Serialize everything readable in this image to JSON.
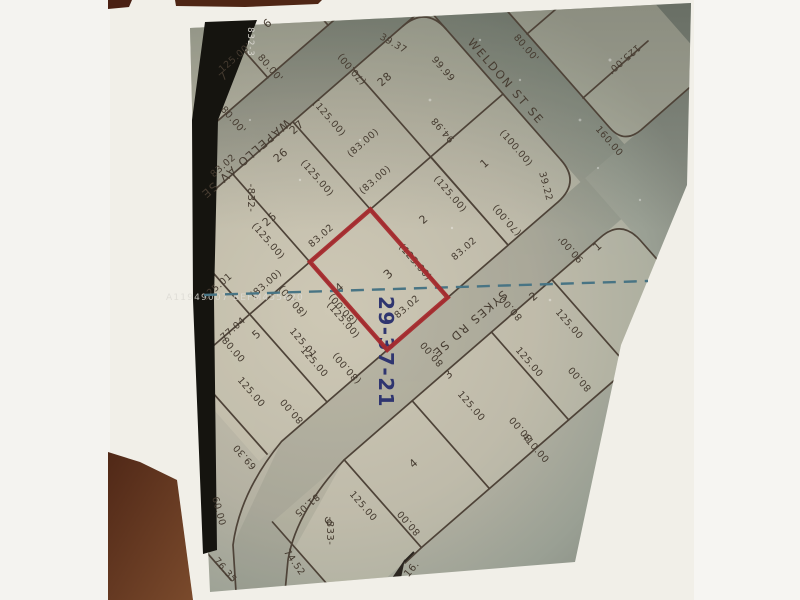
{
  "plat": {
    "colors": {
      "highlight": "#a62b2e",
      "stamp": "#2f3570",
      "dash": "#487484",
      "ink": "#4e4338"
    },
    "labels": [
      {
        "t": "6",
        "x": 270,
        "y": 26,
        "r": -41,
        "s": 11,
        "n": "lot-6-number"
      },
      {
        "t": "125.00'",
        "x": 237,
        "y": 60,
        "r": -41,
        "s": 9.5,
        "n": "dimension-label"
      },
      {
        "t": "7",
        "x": 226,
        "y": 79,
        "r": -41,
        "s": 11,
        "n": "lot-7-number"
      },
      {
        "t": "80.00'",
        "x": 268,
        "y": 70,
        "r": 49,
        "s": 9.5,
        "n": "dimension-label"
      },
      {
        "t": "80.00'",
        "x": 231,
        "y": 122,
        "r": 49,
        "s": 9.5,
        "n": "dimension-label"
      },
      {
        "t": "WAPELLO AV SE",
        "x": 243,
        "y": 156,
        "r": 139,
        "s": 11.5,
        "c": "street",
        "n": "street-name-wapello"
      },
      {
        "t": "(70.00)",
        "x": 354,
        "y": 67,
        "r": 229,
        "s": 9.5,
        "n": "dimension-label"
      },
      {
        "t": "39.37",
        "x": 392,
        "y": 46,
        "r": 30,
        "s": 9.5,
        "n": "dimension-label"
      },
      {
        "t": "28",
        "x": 387,
        "y": 82,
        "r": -41,
        "s": 11,
        "n": "lot-28-number"
      },
      {
        "t": "99.99",
        "x": 441,
        "y": 71,
        "r": 49,
        "s": 9.5,
        "n": "dimension-label"
      },
      {
        "t": "94.98",
        "x": 445,
        "y": 128,
        "r": 229,
        "s": 9.5,
        "n": "dimension-label"
      },
      {
        "t": "WELDON ST SE",
        "x": 503,
        "y": 84,
        "r": 49,
        "s": 11.5,
        "c": "street",
        "n": "street-name-weldon"
      },
      {
        "t": "80.00'",
        "x": 524,
        "y": 50,
        "r": 49,
        "s": 9.5,
        "n": "dimension-label"
      },
      {
        "t": "125.00'",
        "x": 622,
        "y": 57,
        "r": 139,
        "s": 9.5,
        "n": "dimension-label"
      },
      {
        "t": "160.00",
        "x": 607,
        "y": 143,
        "r": 49,
        "s": 9.5,
        "n": "dimension-label"
      },
      {
        "t": "27",
        "x": 299,
        "y": 130,
        "r": -41,
        "s": 11,
        "n": "lot-27-number"
      },
      {
        "t": "(125.00)",
        "x": 327,
        "y": 120,
        "r": 49,
        "s": 9.5,
        "n": "dimension-label"
      },
      {
        "t": "(83.00)",
        "x": 365,
        "y": 145,
        "r": -41,
        "s": 9.5,
        "n": "dimension-label"
      },
      {
        "t": "26",
        "x": 283,
        "y": 158,
        "r": -41,
        "s": 11,
        "n": "lot-26-number"
      },
      {
        "t": "83.02",
        "x": 225,
        "y": 168,
        "r": -41,
        "s": 9.5,
        "n": "dimension-label"
      },
      {
        "t": "(125.00)",
        "x": 315,
        "y": 180,
        "r": 49,
        "s": 9.5,
        "n": "dimension-label"
      },
      {
        "t": "(83.00)",
        "x": 377,
        "y": 182,
        "r": -41,
        "s": 9.5,
        "n": "dimension-label"
      },
      {
        "t": "-832-",
        "x": 248,
        "y": 198,
        "r": 90,
        "s": 10,
        "n": "block-832-number"
      },
      {
        "t": "25",
        "x": 272,
        "y": 222,
        "r": -41,
        "s": 11,
        "n": "lot-25-number"
      },
      {
        "t": "(125.00)",
        "x": 266,
        "y": 243,
        "r": 49,
        "s": 9.5,
        "n": "dimension-label"
      },
      {
        "t": "83.02",
        "x": 323,
        "y": 238,
        "r": -41,
        "s": 9.5,
        "n": "dimension-label"
      },
      {
        "t": "2",
        "x": 426,
        "y": 222,
        "r": -41,
        "s": 11,
        "n": "lot-2-number"
      },
      {
        "t": "(125.00)",
        "x": 448,
        "y": 196,
        "r": 49,
        "s": 9.5,
        "n": "dimension-label"
      },
      {
        "t": "1",
        "x": 487,
        "y": 166,
        "r": -41,
        "s": 11,
        "n": "lot-1-number"
      },
      {
        "t": "(100.00)",
        "x": 514,
        "y": 150,
        "r": 49,
        "s": 9.5,
        "n": "dimension-label"
      },
      {
        "t": "39.22",
        "x": 543,
        "y": 187,
        "r": 75,
        "s": 9.5,
        "n": "dimension-label"
      },
      {
        "t": "(70.00)",
        "x": 509,
        "y": 218,
        "r": 229,
        "s": 9.5,
        "n": "dimension-label"
      },
      {
        "t": "83.02",
        "x": 466,
        "y": 251,
        "r": -41,
        "s": 9.5,
        "n": "dimension-label"
      },
      {
        "t": "3",
        "x": 391,
        "y": 277,
        "r": -41,
        "s": 12,
        "n": "highlighted-lot-3-number"
      },
      {
        "t": "(125.00)",
        "x": 413,
        "y": 264,
        "r": 49,
        "s": 9.5,
        "n": "dimension-label"
      },
      {
        "t": "83.02",
        "x": 409,
        "y": 309,
        "r": -41,
        "s": 9.5,
        "n": "dimension-label"
      },
      {
        "t": "4",
        "x": 342,
        "y": 290,
        "r": -41,
        "s": 11,
        "n": "lot-4-number"
      },
      {
        "t": "(80.00)",
        "x": 345,
        "y": 307,
        "r": 229,
        "s": 9.5,
        "n": "dimension-label"
      },
      {
        "t": "(125.00)",
        "x": 341,
        "y": 322,
        "r": 49,
        "s": 9.5,
        "n": "dimension-label"
      },
      {
        "t": "125.01",
        "x": 219,
        "y": 289,
        "r": -41,
        "s": 9.5,
        "n": "dimension-label"
      },
      {
        "t": "(83.00)",
        "x": 268,
        "y": 286,
        "r": -41,
        "s": 9.5,
        "n": "dimension-label"
      },
      {
        "t": "(80.00)",
        "x": 295,
        "y": 299,
        "r": 229,
        "s": 9.5,
        "n": "dimension-label"
      },
      {
        "t": "77.04",
        "x": 235,
        "y": 331,
        "r": -41,
        "s": 9.5,
        "n": "dimension-label"
      },
      {
        "t": "5",
        "x": 259,
        "y": 337,
        "r": -41,
        "s": 11,
        "n": "lot-5-number"
      },
      {
        "t": "80.00",
        "x": 231,
        "y": 352,
        "r": 49,
        "s": 9.5,
        "n": "dimension-label"
      },
      {
        "t": "125.01",
        "x": 301,
        "y": 345,
        "r": 49,
        "s": 9.5,
        "n": "dimension-label"
      },
      {
        "t": "125.00",
        "x": 312,
        "y": 364,
        "r": 49,
        "s": 9.5,
        "n": "dimension-label"
      },
      {
        "t": "125.00",
        "x": 249,
        "y": 394,
        "r": 49,
        "s": 9.5,
        "n": "dimension-label"
      },
      {
        "t": "80.00",
        "x": 294,
        "y": 409,
        "r": 229,
        "s": 9.5,
        "n": "dimension-label"
      },
      {
        "t": "69.30",
        "x": 247,
        "y": 455,
        "r": 229,
        "s": 9.5,
        "n": "dimension-label"
      },
      {
        "t": "60.00",
        "x": 216,
        "y": 512,
        "r": 75,
        "s": 9.5,
        "n": "dimension-label"
      },
      {
        "t": "76.35",
        "x": 223,
        "y": 572,
        "r": 49,
        "s": 9.5,
        "n": "dimension-label"
      },
      {
        "t": "(80.00)",
        "x": 349,
        "y": 366,
        "r": 229,
        "s": 9.5,
        "n": "dimension-label"
      },
      {
        "t": "SYKES RD SE",
        "x": 467,
        "y": 321,
        "r": 139,
        "s": 11.5,
        "c": "street",
        "n": "street-name-sykes"
      },
      {
        "t": "2",
        "x": 536,
        "y": 299,
        "r": -41,
        "s": 11,
        "n": "lot-2-number-block-833"
      },
      {
        "t": "80.00",
        "x": 513,
        "y": 306,
        "r": 229,
        "s": 9.5,
        "n": "dimension-label"
      },
      {
        "t": "125.00",
        "x": 567,
        "y": 326,
        "r": 49,
        "s": 9.5,
        "n": "dimension-label"
      },
      {
        "t": "80.00",
        "x": 582,
        "y": 377,
        "r": 229,
        "s": 9.5,
        "n": "dimension-label"
      },
      {
        "t": "125.00",
        "x": 527,
        "y": 364,
        "r": 49,
        "s": 9.5,
        "n": "dimension-label"
      },
      {
        "t": "3",
        "x": 451,
        "y": 377,
        "r": -41,
        "s": 11,
        "n": "lot-3-number-block-833"
      },
      {
        "t": "80.00",
        "x": 434,
        "y": 352,
        "r": 229,
        "s": 9.5,
        "n": "dimension-label"
      },
      {
        "t": "125.00",
        "x": 469,
        "y": 408,
        "r": 49,
        "s": 9.5,
        "n": "dimension-label"
      },
      {
        "t": "4",
        "x": 416,
        "y": 466,
        "r": -41,
        "s": 11,
        "n": "lot-4-number-block-833"
      },
      {
        "t": "80.00",
        "x": 523,
        "y": 427,
        "r": 229,
        "s": 9.5,
        "n": "dimension-label"
      },
      {
        "t": "410.00",
        "x": 533,
        "y": 450,
        "r": 49,
        "s": 9.5,
        "n": "dimension-label"
      },
      {
        "t": "80.00",
        "x": 411,
        "y": 521,
        "r": 229,
        "s": 9.5,
        "n": "dimension-label"
      },
      {
        "t": "6",
        "x": 331,
        "y": 524,
        "r": -41,
        "s": 11,
        "n": "lot-6-number-block-833"
      },
      {
        "t": "81.05",
        "x": 305,
        "y": 503,
        "r": 139,
        "s": 9.5,
        "n": "dimension-label"
      },
      {
        "t": "-833-",
        "x": 327,
        "y": 531,
        "r": 90,
        "s": 10,
        "n": "block-833-number"
      },
      {
        "t": "125.00",
        "x": 361,
        "y": 508,
        "r": 49,
        "s": 9.5,
        "n": "dimension-label"
      },
      {
        "t": "74.52",
        "x": 292,
        "y": 564,
        "r": 55,
        "s": 9.5,
        "n": "dimension-label"
      },
      {
        "t": "16.",
        "x": 414,
        "y": 571,
        "r": -50,
        "s": 10,
        "n": "match-line-label"
      },
      {
        "t": "1",
        "x": 600,
        "y": 249,
        "r": -41,
        "s": 11,
        "n": "lot-1-number-block-833"
      },
      {
        "t": "90.00'",
        "x": 573,
        "y": 247,
        "r": 229,
        "s": 9.5,
        "n": "dimension-label"
      },
      {
        "t": "832-3",
        "x": 248,
        "y": 42,
        "r": 90,
        "s": 8.5,
        "c": "white",
        "n": "scan-edge-label"
      },
      {
        "t": "29-37-21",
        "x": 379,
        "y": 352,
        "r": 90,
        "s": 20,
        "c": "blue",
        "n": "section-township-range-stamp"
      },
      {
        "t": "A11949007 BEFM455420",
        "x": 166,
        "y": 300,
        "r": 0,
        "s": 9,
        "c": "wm",
        "n": "mls-watermark"
      }
    ]
  }
}
